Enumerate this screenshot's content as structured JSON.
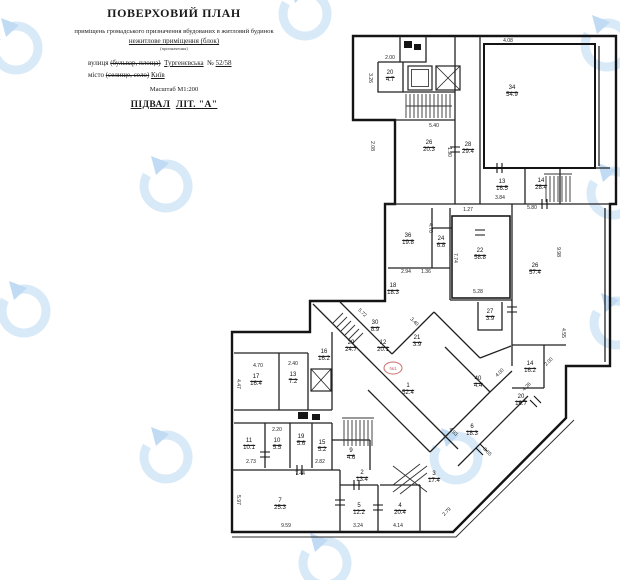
{
  "document": {
    "title": "ПОВЕРХОВИЙ ПЛАН",
    "subtitle_line1": "приміщень громадського призначення вбудованих в житловий будинок",
    "subtitle_line2": "нежитлове приміщення (блок)",
    "subtitle_note": "(призначення)",
    "street_label": "вулиця",
    "street_struck": "(бульвар, площа)",
    "street_value": "Тургенєвська",
    "number_label": "№",
    "number_value": "52/58",
    "city_label": "місто",
    "city_struck": "(селище, село)",
    "city_value": "Київ",
    "scale": "Масштаб М1:200",
    "floor_label": "ПІДВАЛ",
    "liter_label": "ЛІТ. \"А\""
  },
  "stamp": {
    "text": "№1",
    "color": "#c96b6b"
  },
  "watermark": {
    "ring_color": "#d8e9f8",
    "arrow_color": "#c0dbf3"
  },
  "plan": {
    "ink_color": "#1c1c1c",
    "rooms": [
      {
        "n": "20",
        "a": "4.7",
        "x": 390,
        "y": 77
      },
      {
        "n": "26",
        "a": "20.3",
        "x": 429,
        "y": 147
      },
      {
        "n": "28",
        "a": "29.4",
        "x": 468,
        "y": 149
      },
      {
        "n": "34",
        "a": "54.9",
        "x": 512,
        "y": 92
      },
      {
        "n": "13",
        "a": "16.5",
        "x": 502,
        "y": 186
      },
      {
        "n": "14",
        "a": "28.4",
        "x": 541,
        "y": 185
      },
      {
        "n": "36",
        "a": "19.8",
        "x": 408,
        "y": 240
      },
      {
        "n": "24",
        "a": "6.8",
        "x": 441,
        "y": 243
      },
      {
        "n": "22",
        "a": "58.8",
        "x": 480,
        "y": 255
      },
      {
        "n": "26",
        "a": "57.4",
        "x": 535,
        "y": 270
      },
      {
        "n": "27",
        "a": "3.9",
        "x": 490,
        "y": 316
      },
      {
        "n": "18",
        "a": "18.3",
        "x": 393,
        "y": 290
      },
      {
        "n": "30",
        "a": "8.9",
        "x": 375,
        "y": 327
      },
      {
        "n": "29",
        "a": "24.7",
        "x": 351,
        "y": 347
      },
      {
        "n": "12",
        "a": "20.1",
        "x": 383,
        "y": 347
      },
      {
        "n": "21",
        "a": "3.9",
        "x": 417,
        "y": 342
      },
      {
        "n": "16",
        "a": "16.2",
        "x": 324,
        "y": 356
      },
      {
        "n": "17",
        "a": "16.4",
        "x": 256,
        "y": 381
      },
      {
        "n": "13",
        "a": "7.2",
        "x": 293,
        "y": 379
      },
      {
        "n": "11",
        "a": "10.1",
        "x": 249,
        "y": 445
      },
      {
        "n": "10",
        "a": "5.5",
        "x": 277,
        "y": 445
      },
      {
        "n": "19",
        "a": "5.6",
        "x": 301,
        "y": 441
      },
      {
        "n": "15",
        "a": "5.2",
        "x": 322,
        "y": 447
      },
      {
        "n": "9",
        "a": "4.6",
        "x": 351,
        "y": 455
      },
      {
        "n": "7",
        "a": "25.3",
        "x": 280,
        "y": 505
      },
      {
        "n": "5",
        "a": "12.2",
        "x": 359,
        "y": 510
      },
      {
        "n": "2",
        "a": "13.4",
        "x": 362,
        "y": 477
      },
      {
        "n": "4",
        "a": "20.4",
        "x": 400,
        "y": 510
      },
      {
        "n": "3",
        "a": "17.4",
        "x": 434,
        "y": 478
      },
      {
        "n": "1",
        "a": "52.4",
        "x": 408,
        "y": 390
      },
      {
        "n": "40",
        "a": "4.4",
        "x": 478,
        "y": 383
      },
      {
        "n": "14",
        "a": "16.2",
        "x": 530,
        "y": 368
      },
      {
        "n": "20",
        "a": "16.7",
        "x": 521,
        "y": 401
      },
      {
        "n": "6",
        "a": "18.3",
        "x": 472,
        "y": 431
      }
    ],
    "dims": [
      {
        "t": "2.00",
        "x": 390,
        "y": 58,
        "r": 0
      },
      {
        "t": "4.08",
        "x": 508,
        "y": 41,
        "r": 0
      },
      {
        "t": "3.26",
        "x": 370,
        "y": 78,
        "r": 90
      },
      {
        "t": "2.08",
        "x": 372,
        "y": 146,
        "r": 90
      },
      {
        "t": "5.40",
        "x": 434,
        "y": 126,
        "r": 0
      },
      {
        "t": "1.90",
        "x": 449,
        "y": 152,
        "r": 90
      },
      {
        "t": "3.84",
        "x": 500,
        "y": 198,
        "r": 0
      },
      {
        "t": "1.27",
        "x": 468,
        "y": 210,
        "r": 0
      },
      {
        "t": "5.80",
        "x": 532,
        "y": 208,
        "r": 0
      },
      {
        "t": "7.74",
        "x": 455,
        "y": 258,
        "r": 90
      },
      {
        "t": "9.98",
        "x": 558,
        "y": 252,
        "r": 90
      },
      {
        "t": "4.70",
        "x": 430,
        "y": 228,
        "r": 90
      },
      {
        "t": "2.94",
        "x": 406,
        "y": 272,
        "r": 0
      },
      {
        "t": "1.36",
        "x": 426,
        "y": 272,
        "r": 0
      },
      {
        "t": "5.28",
        "x": 478,
        "y": 292,
        "r": 0
      },
      {
        "t": "4.55",
        "x": 563,
        "y": 333,
        "r": 90
      },
      {
        "t": "5.72",
        "x": 362,
        "y": 313,
        "r": 45
      },
      {
        "t": "3.40",
        "x": 414,
        "y": 322,
        "r": 45
      },
      {
        "t": "4.70",
        "x": 258,
        "y": 366,
        "r": 0
      },
      {
        "t": "4.47",
        "x": 238,
        "y": 384,
        "r": 90
      },
      {
        "t": "2.40",
        "x": 293,
        "y": 364,
        "r": 0
      },
      {
        "t": "2.20",
        "x": 277,
        "y": 430,
        "r": 0
      },
      {
        "t": "2.73",
        "x": 251,
        "y": 462,
        "r": 0
      },
      {
        "t": "2.82",
        "x": 320,
        "y": 462,
        "r": 0
      },
      {
        "t": "7.44",
        "x": 300,
        "y": 474,
        "r": 0
      },
      {
        "t": "9.59",
        "x": 286,
        "y": 526,
        "r": 0
      },
      {
        "t": "3.24",
        "x": 358,
        "y": 526,
        "r": 0
      },
      {
        "t": "4.14",
        "x": 398,
        "y": 526,
        "r": 0
      },
      {
        "t": "2.79",
        "x": 447,
        "y": 512,
        "r": -45
      },
      {
        "t": "4.93",
        "x": 453,
        "y": 432,
        "r": 45
      },
      {
        "t": "3.65",
        "x": 487,
        "y": 452,
        "r": 45
      },
      {
        "t": "4.26",
        "x": 527,
        "y": 387,
        "r": -45
      },
      {
        "t": "2.00",
        "x": 549,
        "y": 362,
        "r": -45
      },
      {
        "t": "4.00",
        "x": 500,
        "y": 373,
        "r": -45
      },
      {
        "t": "5.97",
        "x": 238,
        "y": 500,
        "r": 90
      }
    ]
  }
}
